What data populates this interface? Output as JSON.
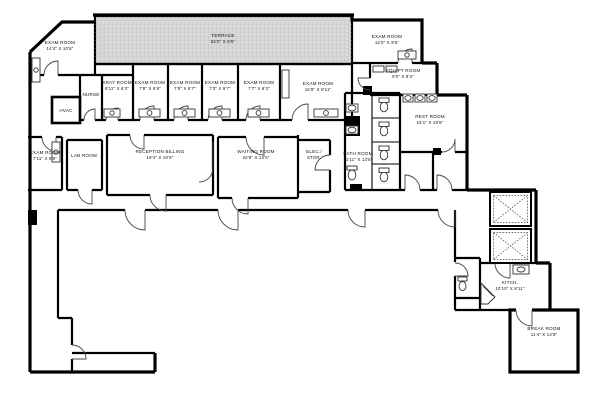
{
  "plan_type": "medical-office-floor-plan",
  "colors": {
    "terrace_fill": "#d8d8d8",
    "wall": "#000000",
    "label": "#111111"
  },
  "rooms": {
    "exam_tl": {
      "name": "EXAM ROOM",
      "dims": "14'4\" X 10'8\""
    },
    "terrace": {
      "name": "TERRACE",
      "dims": "52'0\" X 9'5\""
    },
    "exam_tr": {
      "name": "EXAM ROOM",
      "dims": "12'0\" X 9'5\""
    },
    "nurse": {
      "name": "NURSE",
      "dims": ""
    },
    "xray": {
      "name": "XRAY ROOM",
      "dims": "8'11\" X 6'3\""
    },
    "exam_1": {
      "name": "EXAM ROOM",
      "dims": "7'8\" X 9'8\""
    },
    "exam_2": {
      "name": "EXAM ROOM",
      "dims": "7'8\" X 9'7\""
    },
    "exam_3": {
      "name": "EXAM ROOM",
      "dims": "7'3\" X 9'7\""
    },
    "exam_4": {
      "name": "EXAM ROOM",
      "dims": "7'7\" X 9'3\""
    },
    "exam_wide": {
      "name": "EXAM ROOM",
      "dims": "16'8\" X 8'11\""
    },
    "equip": {
      "name": "EQUIPT ROOM",
      "dims": "9'0\" X 8'3\""
    },
    "hvac": {
      "name": "HVAC",
      "dims": ""
    },
    "exam_left": {
      "name": "EXAM ROOM",
      "dims": "7'11\" X 9'9\""
    },
    "lab": {
      "name": "LAB ROOM",
      "dims": ""
    },
    "reception": {
      "name": "RECEPTION BILLING",
      "dims": "19'4\" X 10'8\""
    },
    "waiting": {
      "name": "WAITING ROOM",
      "dims": "20'8\" X 13'0\""
    },
    "elec": {
      "name": "ELEC./",
      "dims": "STOR."
    },
    "bath": {
      "name": "BATH ROOM",
      "dims": "11'11\" X 13'8\""
    },
    "rest": {
      "name": "REST ROOM",
      "dims": "16'1\" X 19'8\""
    },
    "kitch": {
      "name": "KITCH.",
      "dims": "10'10\" X 8'11\""
    },
    "break_room": {
      "name": "BREAK ROOM",
      "dims": "11'4\" X 14'8\""
    }
  }
}
